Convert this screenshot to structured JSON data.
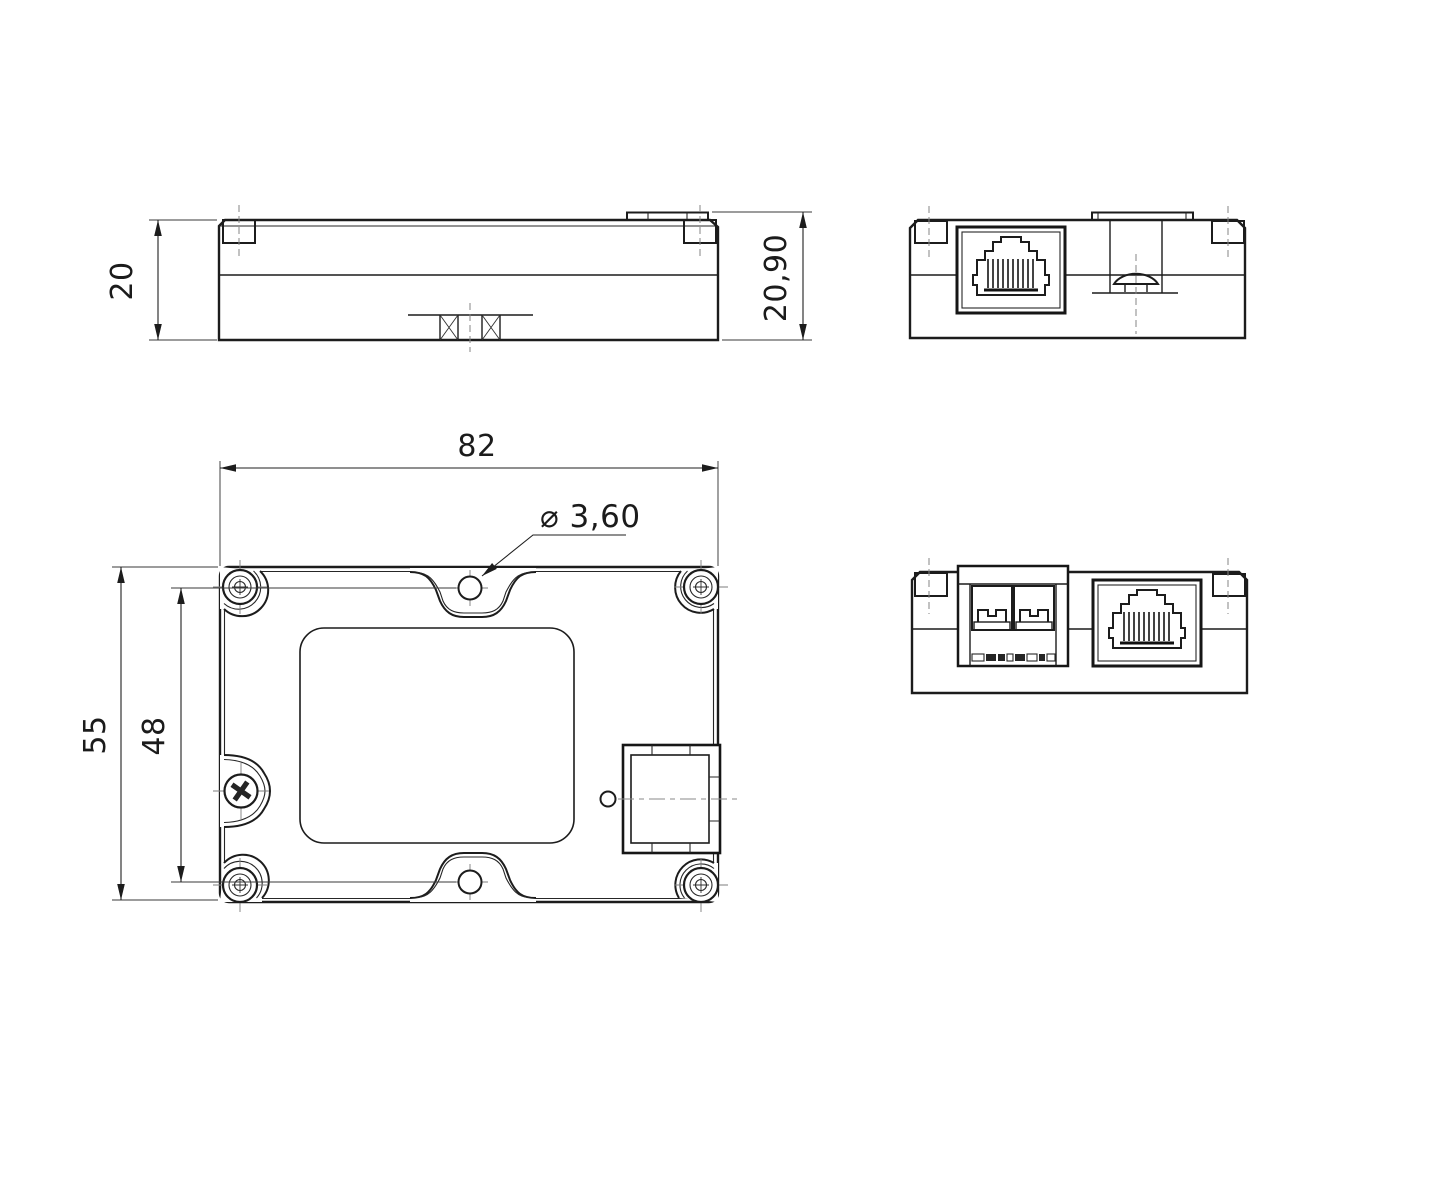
{
  "drawing": {
    "dimensions": {
      "plan_width": "82",
      "plan_depth": "55",
      "mounting_hole_spacing": "48",
      "body_height": "20",
      "overall_height": "20,90",
      "mounting_hole_diameter": "⌀ 3,60"
    },
    "colors": {
      "line": "#1c1c1c",
      "centerline": "#868686",
      "background": "#ffffff"
    }
  }
}
